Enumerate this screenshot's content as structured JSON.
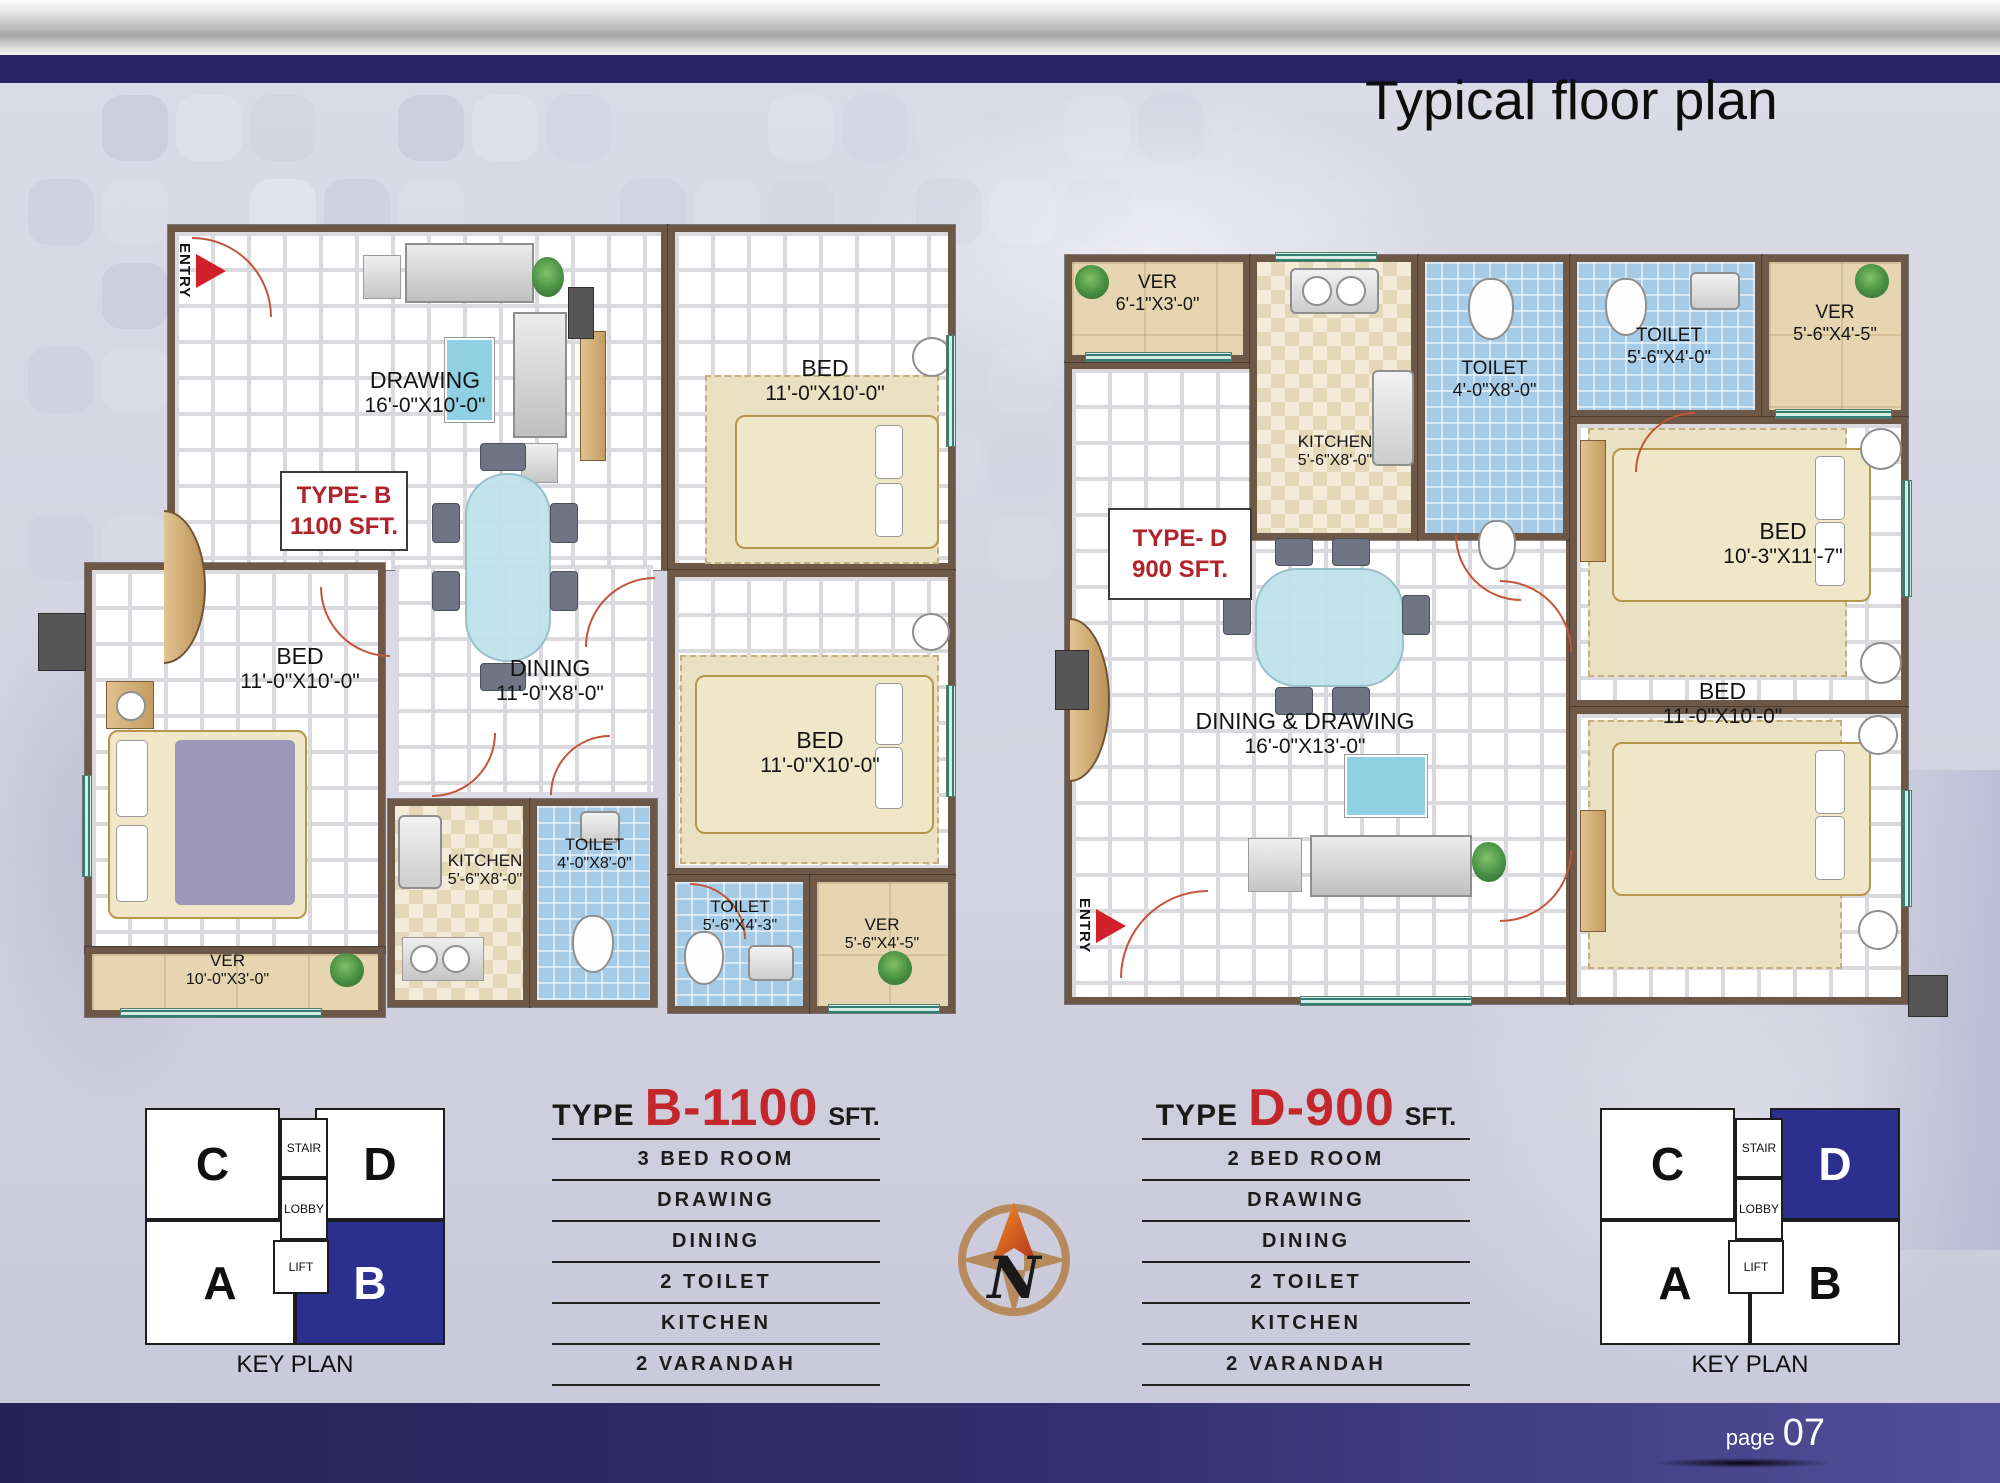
{
  "title": "Typical floor plan",
  "page": {
    "label": "page",
    "number": "07"
  },
  "compass": {
    "letter": "N"
  },
  "colors": {
    "accent_red": "#c3272b",
    "navy_bar": "#2a2467",
    "keyplan_blue": "#2b2f8e",
    "wall_brown": "#6d5847"
  },
  "plan_b": {
    "type_line1": "TYPE- B",
    "type_line2": "1100 SFT.",
    "entry": "ENTRY",
    "rooms": {
      "drawing": {
        "name": "DRAWING",
        "dim": "16'-0\"X10'-0\""
      },
      "bed_top": {
        "name": "BED",
        "dim": "11'-0\"X10'-0\""
      },
      "dining": {
        "name": "DINING",
        "dim": "11'-0\"X8'-0\""
      },
      "bed_left": {
        "name": "BED",
        "dim": "11'-0\"X10'-0\""
      },
      "kitchen": {
        "name": "KITCHEN",
        "dim": "5'-6\"X8'-0\""
      },
      "toilet1": {
        "name": "TOILET",
        "dim": "4'-0\"X8'-0\""
      },
      "bed_right": {
        "name": "BED",
        "dim": "11'-0\"X10'-0\""
      },
      "toilet2": {
        "name": "TOILET",
        "dim": "5'-6\"X4'-3\""
      },
      "ver1": {
        "name": "VER",
        "dim": "10'-0\"X3'-0\""
      },
      "ver2": {
        "name": "VER",
        "dim": "5'-6\"X4'-5\""
      }
    }
  },
  "plan_d": {
    "type_line1": "TYPE- D",
    "type_line2": "900 SFT.",
    "entry": "ENTRY",
    "rooms": {
      "ver1": {
        "name": "VER",
        "dim": "6'-1\"X3'-0\""
      },
      "kitchen": {
        "name": "KITCHEN",
        "dim": "5'-6\"X8'-0\""
      },
      "toilet1": {
        "name": "TOILET",
        "dim": "4'-0\"X8'-0\""
      },
      "toilet2": {
        "name": "TOILET",
        "dim": "5'-6\"X4'-0\""
      },
      "ver2": {
        "name": "VER",
        "dim": "5'-6\"X4'-5\""
      },
      "bed_top": {
        "name": "BED",
        "dim": "10'-3\"X11'-7\""
      },
      "dining_draw": {
        "name": "DINING & DRAWING",
        "dim": "16'-0\"X13'-0\""
      },
      "bed_bottom": {
        "name": "BED",
        "dim": "11'-0\"X10'-0\""
      }
    }
  },
  "spec_b": {
    "type_word": "TYPE",
    "code": "B-1100",
    "sft": "SFT.",
    "items": [
      "3 BED ROOM",
      "DRAWING",
      "DINING",
      "2 TOILET",
      "KITCHEN",
      "2 VARANDAH"
    ]
  },
  "spec_d": {
    "type_word": "TYPE",
    "code": "D-900",
    "sft": "SFT.",
    "items": [
      "2 BED ROOM",
      "DRAWING",
      "DINING",
      "2 TOILET",
      "KITCHEN",
      "2 VARANDAH"
    ]
  },
  "key_plan_left": {
    "title": "KEY PLAN",
    "unit_c": "C",
    "unit_d": "D",
    "unit_a": "A",
    "unit_b": "B",
    "stair": "STAIR",
    "lobby": "LOBBY",
    "lift": "LIFT",
    "highlighted_unit": "B"
  },
  "key_plan_right": {
    "title": "KEY PLAN",
    "unit_c": "C",
    "unit_d": "D",
    "unit_a": "A",
    "unit_b": "B",
    "stair": "STAIR",
    "lobby": "LOBBY",
    "lift": "LIFT",
    "highlighted_unit": "D"
  }
}
